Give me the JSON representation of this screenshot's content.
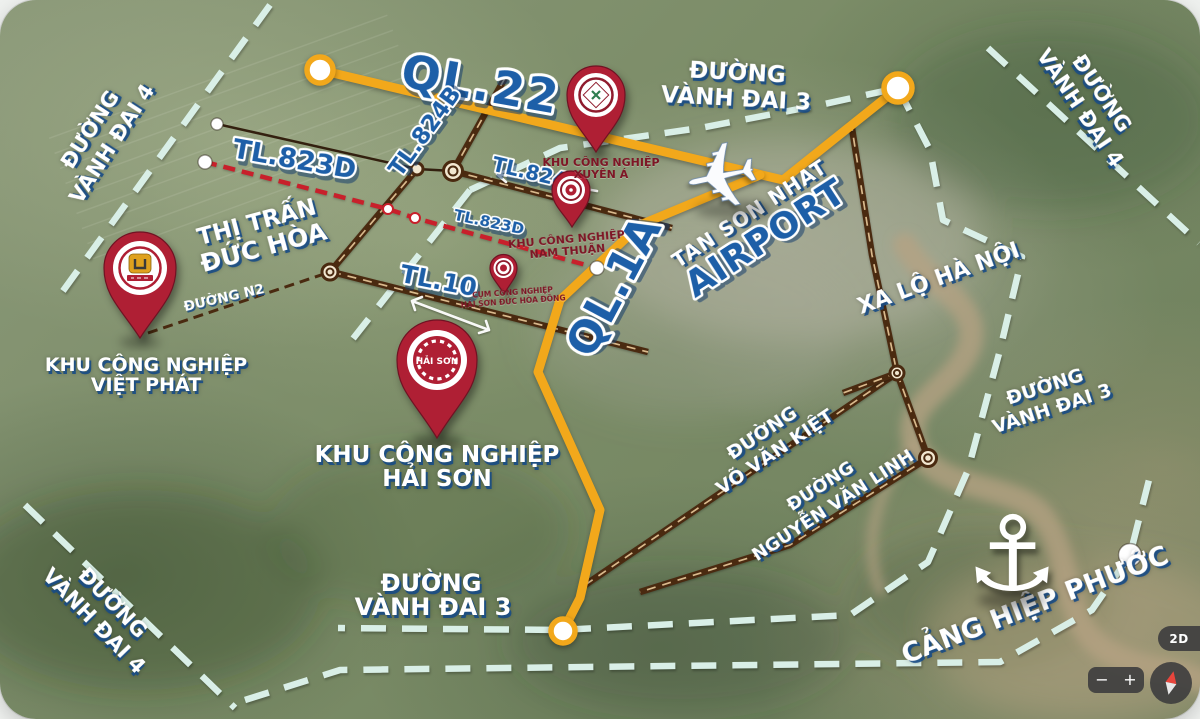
{
  "map": {
    "road_labels": {
      "ql22": "QL.22",
      "ql1a": "QL.1A",
      "tl824b": "TL.824B",
      "tl823d_west": "TL.823D",
      "tl823d_east": "TL.823D",
      "tl824": "TL.824",
      "tl10": "TL.10",
      "duong_n2": "ĐƯỜNG N2",
      "xa_lo_ha_noi": "XA LỘ HÀ NỘI"
    },
    "area_labels": {
      "thi_tran": {
        "line1": "THỊ TRẤN",
        "line2": "ĐỨC HÒA"
      },
      "ring3_top": {
        "line1": "ĐƯỜNG",
        "line2": "VÀNH ĐAI 3"
      },
      "ring3_right": {
        "line1": "ĐƯỜNG",
        "line2": "VÀNH ĐAI 3"
      },
      "ring3_bottom": {
        "line1": "ĐƯỜNG",
        "line2": "VÀNH ĐAI 3"
      },
      "ring4_top_left": {
        "line1": "ĐƯỜNG",
        "line2": "VÀNH ĐAI 4"
      },
      "ring4_top_right": {
        "line1": "ĐƯỜNG",
        "line2": "VÀNH ĐAI 4"
      },
      "ring4_bottom_left": {
        "line1": "ĐƯỜNG",
        "line2": "VÀNH ĐAI 4"
      },
      "vo_van_kiet": {
        "line1": "ĐƯỜNG",
        "line2": "VÕ VĂN KIỆT"
      },
      "nguyen_van_linh": {
        "line1": "ĐƯỜNG",
        "line2": "NGUYỄN VĂN LINH"
      },
      "airport": {
        "line1": "TAN SON NHAT",
        "line2": "AIRPORT"
      },
      "port": "CẢNG HIỆP PHƯỚC"
    },
    "pins": {
      "xuyen_a": {
        "line1": "KHU CÔNG NGHIỆP",
        "line2": "XUYÊN Á"
      },
      "nam_thuan": {
        "line1": "KHU CÔNG NGHIỆP",
        "line2": "NAM THUẬN"
      },
      "cum_duc_hoa_dong": {
        "line1": "CỤM CÔNG NGHIỆP",
        "line2": "HẢI SƠN ĐỨC HÒA ĐÔNG"
      },
      "viet_phat": {
        "line1": "KHU CÔNG NGHIỆP",
        "line2": "VIỆT PHÁT"
      },
      "hai_son": {
        "line1": "KHU CÔNG NGHIỆP",
        "line2": "HẢI SƠN",
        "logo": "HẢI SƠN"
      }
    },
    "controls": {
      "mode": "2D",
      "zoom_out": "−",
      "zoom_in": "+"
    }
  },
  "colors": {
    "yellow": "#F2A81B",
    "blue": "#1D5FA8",
    "dash": "#D9EFE7",
    "red": "#C8202B",
    "brown": "#4A2A10",
    "pin": "#AF1F34",
    "pin_dark": "#7E1626"
  }
}
